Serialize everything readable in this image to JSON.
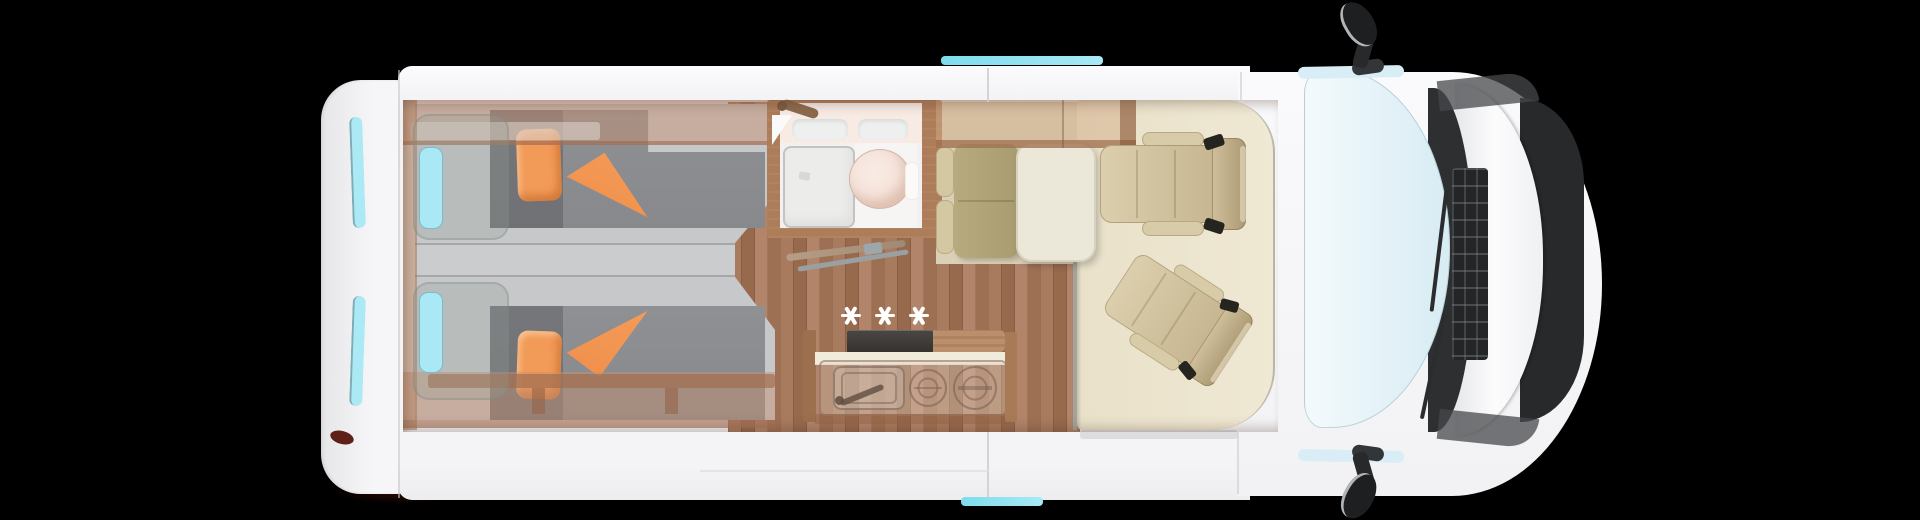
{
  "scene": {
    "type": "camper-van-floorplan",
    "view": "top-down",
    "background": "#000000"
  },
  "hob_marker": {
    "symbol": "✳",
    "symbols": "✳✳✳",
    "count": 3,
    "color": "#ffffff"
  },
  "palette": {
    "bg": "#000000",
    "body": "#f4f4f6",
    "window_cyan": "#a8e9f4",
    "window_int": "#a9e8f4",
    "glass": "#d8ecf3",
    "mattress": "#c7c8ca",
    "duvet": "#8c8d90",
    "orange": "#f29a58",
    "orange_deep": "#ef8f4b",
    "wood_floor": "#a2755a",
    "wood_cab": "#ad7c58",
    "mat": "#e9e1c9",
    "lounge": "#d9d0b6",
    "seat": "#cfc0a0",
    "bench": "#a89c70",
    "table": "#ece8d9",
    "toilet": "#f0d8cc",
    "shower": "#ececeb",
    "trim_dark": "#2d2f31",
    "tan_band": "rgba(196,145,115,0.48)",
    "marker": "#ffffff"
  }
}
